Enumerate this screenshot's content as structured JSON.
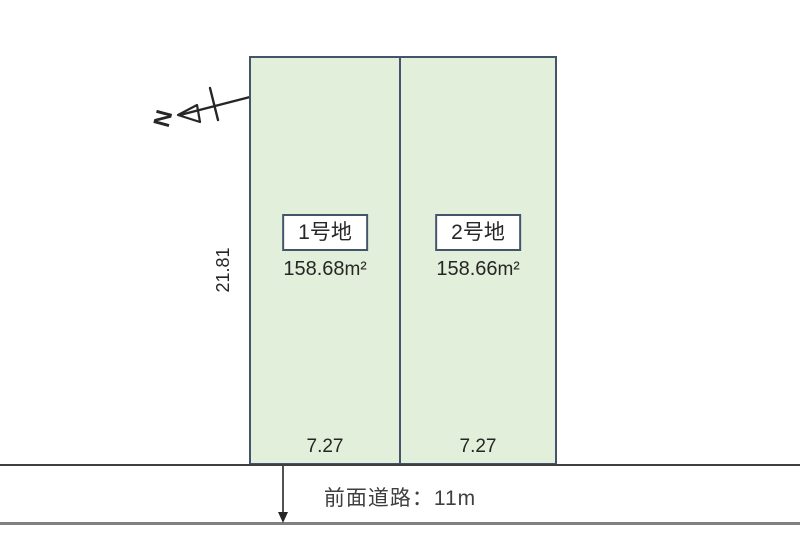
{
  "diagram": {
    "north_label": "N",
    "depth_label": "21.81",
    "road_label": "前面道路：11m",
    "lots": [
      {
        "name": "1号地",
        "area": "158.68",
        "area_unit": "m²",
        "frontage": "7.27"
      },
      {
        "name": "2号地",
        "area": "158.66",
        "area_unit": "m²",
        "frontage": "7.27"
      }
    ],
    "colors": {
      "lot_fill": "#e2efda",
      "lot_border": "#44546a",
      "label_box_border": "#44546a",
      "road_line_dark": "#3f3f3f",
      "road_line_gray": "#808080",
      "text": "#262626"
    }
  }
}
